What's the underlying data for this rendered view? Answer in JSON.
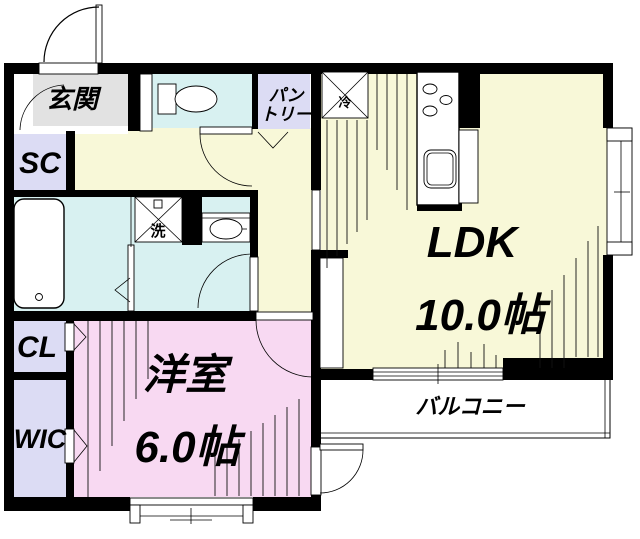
{
  "floorplan": {
    "colors": {
      "wall": "#000000",
      "genkan": "#e2e2e2",
      "closet": "#dcdcf4",
      "water": "#d8f1f1",
      "floor": "#f8f8d8",
      "room": "#f8d9f2",
      "white": "#ffffff"
    },
    "rooms": {
      "genkan": "玄関",
      "shoe_closet": "SC",
      "pantry_line1": "パン",
      "pantry_line2": "トリー",
      "ldk_name": "LDK",
      "ldk_size": "10.0帖",
      "western_room_name": "洋室",
      "western_room_size": "6.0帖",
      "closet": "CL",
      "walk_in_closet": "WIC",
      "balcony": "バルコニー"
    },
    "fixtures": {
      "refrigerator": "冷",
      "washing_machine": "洗"
    }
  }
}
